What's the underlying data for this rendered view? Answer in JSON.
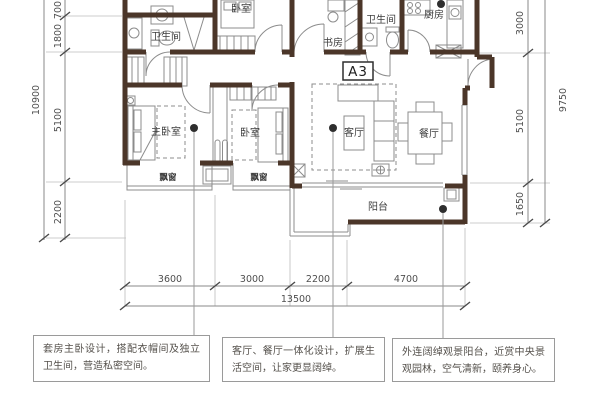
{
  "unit": {
    "label": "A3"
  },
  "rooms": {
    "bathroom_master": "卫生间",
    "bedroom_top": "卧室",
    "study": "书房",
    "bathroom_public": "卫生间",
    "kitchen": "厨房",
    "master_bedroom": "主卧室",
    "bedroom_second": "卧室",
    "living_room": "客厅",
    "dining_room": "餐厅",
    "balcony": "阳台",
    "bay_window": "飘窗"
  },
  "dimensions": {
    "left": {
      "segments": [
        "700",
        "1800",
        "5100",
        "2200"
      ],
      "total": "10900"
    },
    "right": {
      "segments": [
        "3000",
        "5100",
        "1650"
      ],
      "total": "9750"
    },
    "bottom": {
      "segments": [
        "3600",
        "3000",
        "2200",
        "4700"
      ],
      "total": "13500"
    }
  },
  "annotations": [
    {
      "text": "套房主卧设计，搭配衣帽间及独立卫生间，营造私密空间。"
    },
    {
      "text": "客厅、餐厅一体化设计，扩展生活空间，让家更显阔绰。"
    },
    {
      "text": "外连阔绰观景阳台，近赏中央景观园林，空气清新，颐养身心。"
    }
  ],
  "colors": {
    "wall": "#4b3629",
    "line": "#8c8c8c",
    "dot": "#2e2e2e"
  }
}
